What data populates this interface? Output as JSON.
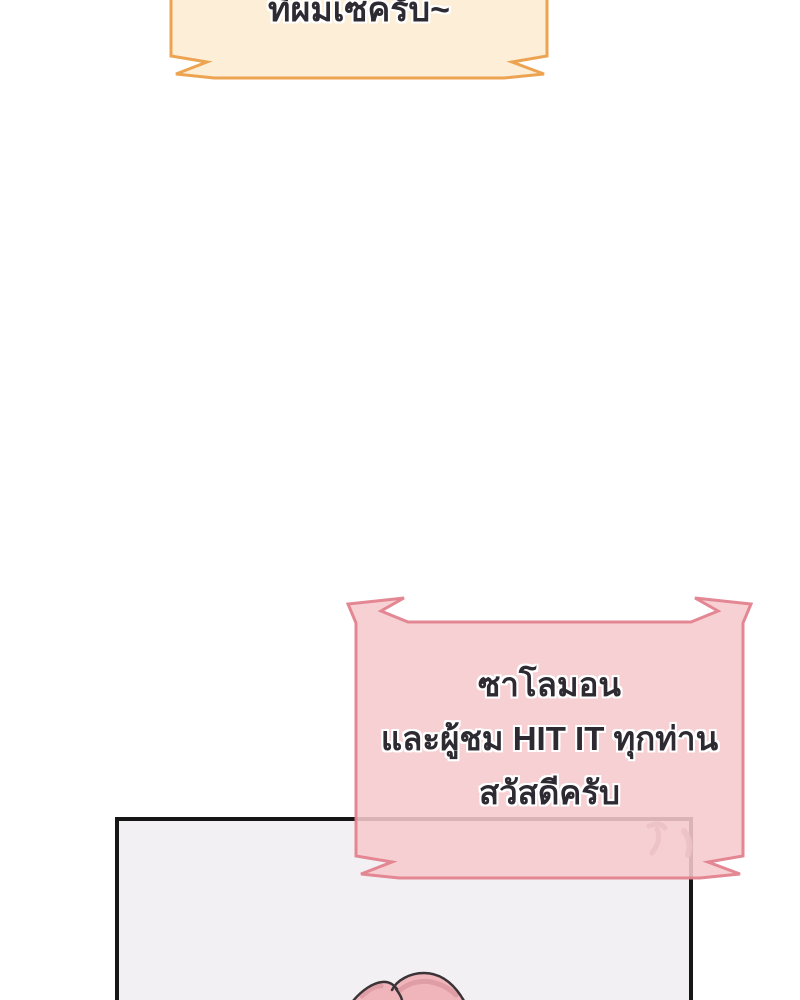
{
  "scene": {
    "type": "webtoon-comic-panel",
    "background_color": "#ffffff"
  },
  "speech_bubbles": {
    "top_cropped": {
      "text": "ที่ผมเซครับ~",
      "fill_color": "#fceed7",
      "border_color": "#eda452",
      "text_color": "#2e2a32"
    },
    "greeting": {
      "line1": "ซาโลมอน",
      "line2": "และผู้ชม HIT IT ทุกท่าน",
      "line3": "สวัสดีครับ",
      "fill_color": "#f6c9cd",
      "border_color": "#e2828e",
      "text_color": "#2e2a32"
    }
  },
  "panel": {
    "border_color": "#161616",
    "background_color": "#f3f0f4"
  },
  "artwork": {
    "hair_fill_color": "#f0b5ba",
    "hair_shade_color": "#dd9aa2",
    "hair_outline_color": "#3b3437",
    "stray_hair_color": "#a18b8f"
  }
}
